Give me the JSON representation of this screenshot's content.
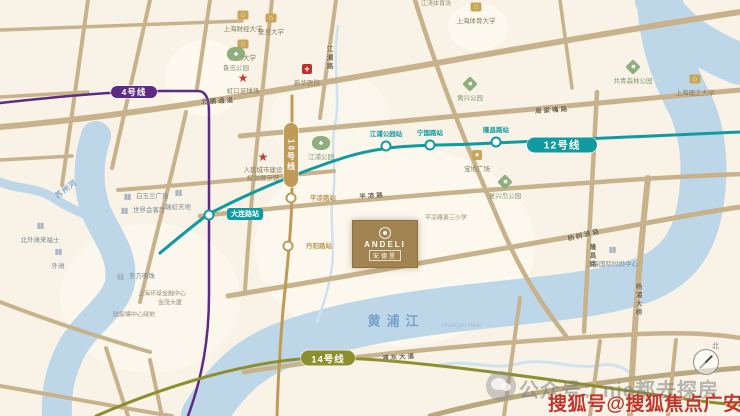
{
  "map": {
    "palette": {
      "bg": "#f8f3e6",
      "road": "#c8b28c",
      "river": "#bdd6e8",
      "creek": "#cfe2ef",
      "patch": "#fdfaf0"
    },
    "patches": [
      {
        "cx": 205,
        "cy": 78,
        "rx": 40,
        "ry": 38,
        "o": 0.9
      },
      {
        "cx": 478,
        "cy": 27,
        "rx": 30,
        "ry": 24,
        "o": 0.9
      },
      {
        "cx": 395,
        "cy": 246,
        "rx": 140,
        "ry": 100,
        "o": 0.75
      },
      {
        "cx": 150,
        "cy": 298,
        "rx": 90,
        "ry": 75,
        "o": 0.6
      },
      {
        "cx": 330,
        "cy": 120,
        "rx": 60,
        "ry": 50,
        "o": 0.5
      }
    ],
    "rivers": [
      {
        "id": "huangpu-river-west",
        "d": "M 96,136 C 86,165 88,196 100,220 C 112,243 123,258 120,282 C 116,306 86,322 71,350 C 59,374 56,394 57,416",
        "w": 30
      },
      {
        "id": "suzhou-creek",
        "d": "M 0,182 C 20,190 36,187 52,197 C 64,205 72,209 84,214",
        "w": 9
      },
      {
        "id": "huangpu-river-main",
        "d": "M 204,416 C 226,380 250,356 292,342 C 342,325 402,315 472,307 C 542,299 606,295 648,278 C 688,261 698,228 702,194 C 706,160 702,130 690,104 C 674,74 662,42 660,0",
        "w": 46
      },
      {
        "id": "huangpu-river-northeast",
        "d": "M 656,0 C 672,28 700,48 740,64",
        "w": 42
      }
    ],
    "creeks": [
      {
        "id": "hongkou-creek",
        "d": "M 338,26 C 332,62 341,95 335,125 C 330,150 337,172 333,195 C 329,222 336,248 331,272 C 328,292 322,308 317,322",
        "w": 2.5
      },
      {
        "id": "south-bank-creek",
        "d": "M 436,366 C 466,358 492,371 517,364 C 547,356 572,371 602,365 C 613,363 621,367 629,372",
        "w": 3
      }
    ],
    "roads": [
      {
        "d": "M 88,0 L 62,185",
        "w": 4
      },
      {
        "d": "M 150,0 L 112,168",
        "w": 4
      },
      {
        "d": "M 210,0 L 197,88",
        "w": 4
      },
      {
        "d": "M 186,112 C 171,180 152,250 140,302",
        "w": 4
      },
      {
        "d": "M 272,0 L 259,124",
        "w": 4
      },
      {
        "d": "M 259,124 C 253,180 249,230 245,290",
        "w": 4
      },
      {
        "d": "M 336,0 L 320,118",
        "w": 4
      },
      {
        "d": "M 0,127 C 220,108 460,55 740,12",
        "w": 6
      },
      {
        "d": "M 240,136 C 430,120 590,104 740,90",
        "w": 5
      },
      {
        "d": "M 0,30 L 242,21",
        "w": 3.5
      },
      {
        "d": "M 0,97 L 88,92",
        "w": 3.5
      },
      {
        "d": "M 118,190 C 210,183 272,177 334,171",
        "w": 4
      },
      {
        "d": "M 200,216 C 320,203 450,192 600,182 C 650,178 700,176 740,174",
        "w": 4.5
      },
      {
        "d": "M 228,296 C 360,274 500,250 620,228 C 662,220 700,213 740,207",
        "w": 5
      },
      {
        "d": "M 244,372 C 360,354 520,340 640,334 C 684,332 716,334 740,338",
        "w": 4.5
      },
      {
        "d": "M 597,92 L 584,332",
        "w": 4.5
      },
      {
        "d": "M 648,178 C 640,250 634,330 630,416",
        "w": 6
      },
      {
        "d": "M 520,298 L 504,416",
        "w": 4
      },
      {
        "d": "M 415,0 C 438,75 468,150 505,235 C 525,280 546,310 566,336",
        "w": 4.5
      },
      {
        "d": "M 560,0 L 572,88",
        "w": 3.5
      },
      {
        "d": "M 0,302 C 52,322 102,338 150,352",
        "w": 4
      },
      {
        "d": "M 106,348 L 128,416",
        "w": 4
      },
      {
        "d": "M 0,386 C 60,396 122,408 172,416",
        "w": 4
      },
      {
        "d": "M 150,360 L 162,416",
        "w": 4
      },
      {
        "d": "M 430,416 C 520,392 622,378 740,368",
        "w": 5,
        "c": "#b9a77e"
      },
      {
        "d": "M 600,341 L 590,416",
        "w": 4
      },
      {
        "d": "M 676,340 L 668,416",
        "w": 4
      },
      {
        "d": "M 0,160 L 72,156",
        "w": 3.5
      }
    ],
    "road_labels": [
      {
        "t": "北横通道",
        "x": 218,
        "y": 100,
        "r": -4
      },
      {
        "t": "周家嘴路",
        "x": 552,
        "y": 109,
        "r": -4
      },
      {
        "t": "杨树浦路",
        "x": 584,
        "y": 234,
        "r": -13
      },
      {
        "t": "平凉路",
        "x": 372,
        "y": 195,
        "r": -4
      },
      {
        "t": "浦东大道",
        "x": 399,
        "y": 356,
        "r": -4
      },
      {
        "t": "隆昌路",
        "x": 591,
        "y": 256,
        "v": 1
      },
      {
        "t": "杨浦大桥",
        "x": 637,
        "y": 300,
        "v": 1
      },
      {
        "t": "江浦路",
        "x": 328,
        "y": 58,
        "v": 1
      }
    ],
    "river_labels": [
      {
        "t": "苏州河",
        "x": 66,
        "y": 189,
        "r": -38,
        "fs": 7.5,
        "c": "#85abc9",
        "ls": 1,
        "b": 1
      },
      {
        "t": "黄浦江",
        "x": 396,
        "y": 320,
        "fs": 13,
        "c": "#74a2c9",
        "ls": 6,
        "b": 1
      },
      {
        "t": "Huangpu River",
        "x": 462,
        "y": 326,
        "fs": 6,
        "c": "#a5bfd6",
        "i": 1
      }
    ]
  },
  "metro_lines": [
    {
      "id": "line-4",
      "label": "4号线",
      "color": "#5e2b82",
      "width": 2.5,
      "path": "M 0,103 C 55,97 105,92 160,91 L 198,91 C 206,91 209,99 209,112 L 209,295 C 209,340 202,378 188,416",
      "pill": {
        "x": 134,
        "y": 92,
        "w": 46,
        "h": 12,
        "fs": 8.5
      }
    },
    {
      "id": "line-12",
      "label": "12号线",
      "color": "#0f9b9f",
      "width": 3,
      "path": "M 160,253 C 178,238 194,225 207,215 C 250,192 302,171 346,157 C 392,143 432,146 472,144 L 740,132",
      "pill": {
        "x": 562,
        "y": 145,
        "w": 70,
        "h": 15,
        "fs": 10.5
      }
    },
    {
      "id": "line-18",
      "label": "18号线",
      "color": "#bf9b57",
      "width": 3,
      "path": "M 292,96 L 292,186 C 292,225 287,270 283,310 C 280,345 278,380 277,416",
      "pill": {
        "x": 291,
        "y": 155,
        "w": 14,
        "h": 64,
        "fs": 8,
        "vertical": true
      }
    },
    {
      "id": "line-14",
      "label": "14号线",
      "color": "#8d8f2f",
      "width": 3,
      "path": "M 96,416 C 160,388 230,367 290,360 C 330,355 390,360 450,367 C 540,377 620,390 700,401 C 715,403 728,404 740,405",
      "pill": {
        "x": 328,
        "y": 358,
        "w": 54,
        "h": 15,
        "fs": 9.5
      }
    }
  ],
  "stations": [
    {
      "id": "dalian-road-station",
      "t": "大连路站",
      "x": 209,
      "y": 215,
      "c": "#0f9b9f",
      "style": "pill",
      "lx": 245,
      "ly": 214
    },
    {
      "id": "jiangpu-park-station",
      "t": "江浦公园站",
      "x": 386,
      "y": 146,
      "c": "#0f9b9f",
      "style": "text",
      "lx": 386,
      "ly": 133
    },
    {
      "id": "ningguo-road-station",
      "t": "宁国路站",
      "x": 430,
      "y": 145,
      "c": "#0f9b9f",
      "style": "text",
      "lx": 430,
      "ly": 132
    },
    {
      "id": "longchang-road-station",
      "t": "隆昌路站",
      "x": 496,
      "y": 142,
      "c": "#0f9b9f",
      "style": "text",
      "lx": 496,
      "ly": 129
    },
    {
      "id": "pingliang-road-station",
      "t": "平凉路站",
      "x": 291,
      "y": 198,
      "c": "#bf9b57",
      "style": "text",
      "lx": 323,
      "ly": 197
    },
    {
      "id": "danyang-road-station",
      "t": "丹阳路站",
      "x": 288,
      "y": 246,
      "c": "#bf9b57",
      "style": "text",
      "lx": 319,
      "ly": 245
    }
  ],
  "landmarks": [
    {
      "id": "shanghai-univ-finance",
      "type": "university",
      "t": "上海财经大学",
      "x": 243,
      "y": 15,
      "lpos": "below"
    },
    {
      "id": "fudan-university",
      "type": "university",
      "t": "复旦大学",
      "x": 271,
      "y": 18,
      "lpos": "below"
    },
    {
      "id": "tongji-university",
      "type": "university",
      "t": "同济大学",
      "x": 243,
      "y": 44,
      "lpos": "below"
    },
    {
      "id": "shanghai-sport-university",
      "type": "university",
      "t": "上海体育大学",
      "x": 476,
      "y": 7,
      "lpos": "below"
    },
    {
      "id": "usst-university",
      "type": "university",
      "t": "上海理工大学",
      "x": 695,
      "y": 79,
      "lpos": "below"
    },
    {
      "id": "xinhua-hospital",
      "type": "hospital",
      "t": "新华医院",
      "x": 307,
      "y": 69,
      "lpos": "below"
    },
    {
      "id": "luxun-park",
      "type": "park",
      "shape": "blob",
      "t": "鲁迅公园",
      "x": 236,
      "y": 54,
      "lpos": "below"
    },
    {
      "id": "huangxing-park",
      "type": "park",
      "shape": "diamond",
      "t": "黄兴公园",
      "x": 470,
      "y": 84,
      "lpos": "below"
    },
    {
      "id": "gongqing-forest-park",
      "type": "park",
      "shape": "diamond",
      "t": "共青森林公园",
      "x": 633,
      "y": 67,
      "lpos": "below"
    },
    {
      "id": "jiangpu-park",
      "type": "park",
      "shape": "blob",
      "t": "江浦公园",
      "x": 321,
      "y": 143,
      "lpos": "below"
    },
    {
      "id": "fuxing-island-park",
      "type": "park",
      "shape": "diamond",
      "t": "复兴岛公园",
      "x": 505,
      "y": 182,
      "lpos": "below"
    },
    {
      "id": "baodi-plaza",
      "type": "mall",
      "t": "宝地广场",
      "x": 477,
      "y": 155,
      "lpos": "below"
    },
    {
      "id": "hongkou-stadium",
      "type": "star",
      "t": "虹口足球场",
      "x": 243,
      "y": 78,
      "lpos": "below"
    },
    {
      "id": "people-city-exhibition",
      "type": "star",
      "t": "人民城市建设\n规划展示馆",
      "x": 263,
      "y": 157,
      "lpos": "below"
    },
    {
      "id": "white-magnolia-plaza",
      "type": "building",
      "t": "白玉兰广场",
      "x": 127,
      "y": 197,
      "lpos": "right"
    },
    {
      "id": "world-reception-hall",
      "type": "building",
      "t": "世界会客厅",
      "x": 124,
      "y": 211,
      "lpos": "right"
    },
    {
      "id": "ruihong-tiandi",
      "type": "building",
      "t": "瑞虹天地",
      "x": 178,
      "y": 193,
      "lpos": "below"
    },
    {
      "id": "north-bund-raffles",
      "type": "building",
      "t": "北外滩来福士",
      "x": 40,
      "y": 226,
      "lpos": "below"
    },
    {
      "id": "the-bund",
      "type": "building",
      "t": "外滩",
      "x": 58,
      "y": 252,
      "lpos": "below"
    },
    {
      "id": "oriental-pearl-tower",
      "type": "building",
      "t": "东方明珠",
      "x": 120,
      "y": 277,
      "lpos": "right"
    },
    {
      "id": "shanghai-world-financial-center",
      "type": "label",
      "t": "上海环球金融中心",
      "x": 162,
      "y": 295
    },
    {
      "id": "jinmao-tower",
      "type": "label",
      "t": "金茂大厦",
      "x": 170,
      "y": 304
    },
    {
      "id": "lujiazui-green",
      "type": "label",
      "t": "陆家嘴中心绿地",
      "x": 134,
      "y": 316
    },
    {
      "id": "intl-fashion-center",
      "type": "building",
      "t": "上海国际时尚中心",
      "x": 612,
      "y": 250,
      "lpos": "below"
    },
    {
      "id": "jiangwan-stadium",
      "type": "label",
      "t": "江湾体育场",
      "x": 436,
      "y": 5
    },
    {
      "id": "pingliang-no3-school",
      "type": "label",
      "t": "平凉路第三小学",
      "x": 446,
      "y": 219
    }
  ],
  "property": {
    "name_en": "ANDELI",
    "name_cn": "安德里"
  },
  "watermark": {
    "wechat_text": "公众号：nje都去探房",
    "sohu_text": "搜狐号@搜狐焦点广安站"
  },
  "compass": {
    "north_label": "北"
  }
}
